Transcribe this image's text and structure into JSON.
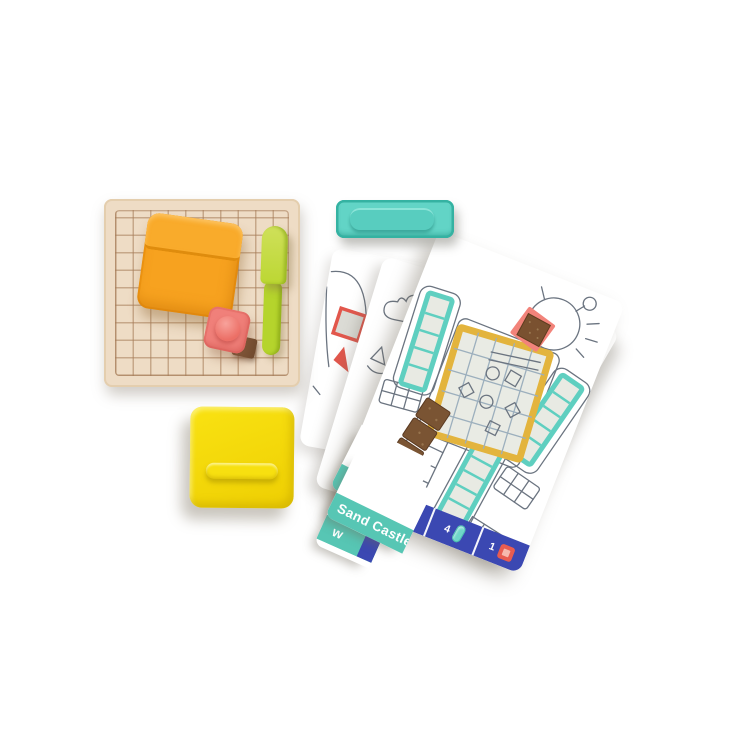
{
  "palette": {
    "background": "#ffffff",
    "board_wood": "#eedcc5",
    "board_line": "#a67c58",
    "pouch_orange": "#f7a21f",
    "stamp_coral": "#f0807a",
    "sand_brown": "#7a5433",
    "spatula_green": "#bcd733",
    "mold_teal": "#62d4c6",
    "case_yellow": "#f4d908",
    "label_teal": "#57c6b4",
    "banner_blue": "#3b48b2",
    "robot_frame_yellow": "#e3b43d",
    "robot_cell_teal": "#5fcfc0",
    "sketch_outline": "#6b7480"
  },
  "cards": {
    "label_robot": "Robot",
    "label_sand_castle": "Sand Castle",
    "label_partial": "w",
    "requirements": [
      {
        "count": "1",
        "icon": "sand-tray-grid-icon"
      },
      {
        "count": "4",
        "icon": "mold-capsule-icon"
      },
      {
        "count": "1",
        "icon": "stamp-square-icon"
      }
    ]
  }
}
